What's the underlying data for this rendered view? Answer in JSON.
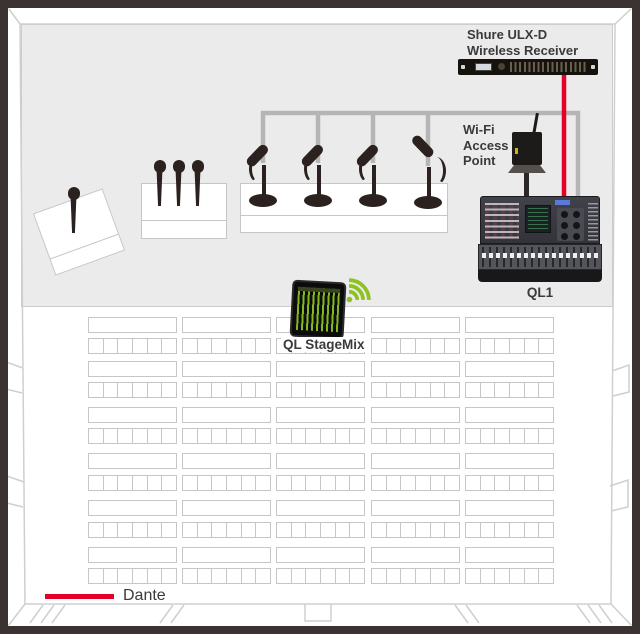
{
  "labels": {
    "receiver_line1": "Shure ULX-D",
    "receiver_line2": "Wireless Receiver",
    "wifi_line1": "Wi-Fi",
    "wifi_line2": "Access",
    "wifi_line3": "Point",
    "console": "QL1",
    "stagemix": "QL StageMix",
    "dante": "Dante"
  },
  "legend": {
    "label": "Dante",
    "line_color": "#e60028"
  },
  "colors": {
    "dante_red": "#e60028",
    "cable_gray": "#b5b5b5",
    "wifi_green": "#8dc21f",
    "stage_gray": "#ebebeb",
    "frame_dark": "#3b3332"
  },
  "devices": [
    {
      "name": "wireless-receiver",
      "label": "Shure ULX-D Wireless Receiver"
    },
    {
      "name": "wifi-access-point",
      "label": "Wi-Fi Access Point"
    },
    {
      "name": "mixing-console",
      "label": "QL1"
    },
    {
      "name": "stagemix-tablet",
      "label": "QL StageMix"
    }
  ],
  "stage": {
    "handheld_wireless_mics_on_lectern": 1,
    "handheld_wireless_mics_in_box": 3,
    "wired_desk_mics_on_head_table": 4
  },
  "seating": {
    "row_pairs": 6,
    "columns": 5,
    "seats_per_block": 6
  },
  "icons": [
    "wifi-signal-icon",
    "antenna-icon"
  ]
}
